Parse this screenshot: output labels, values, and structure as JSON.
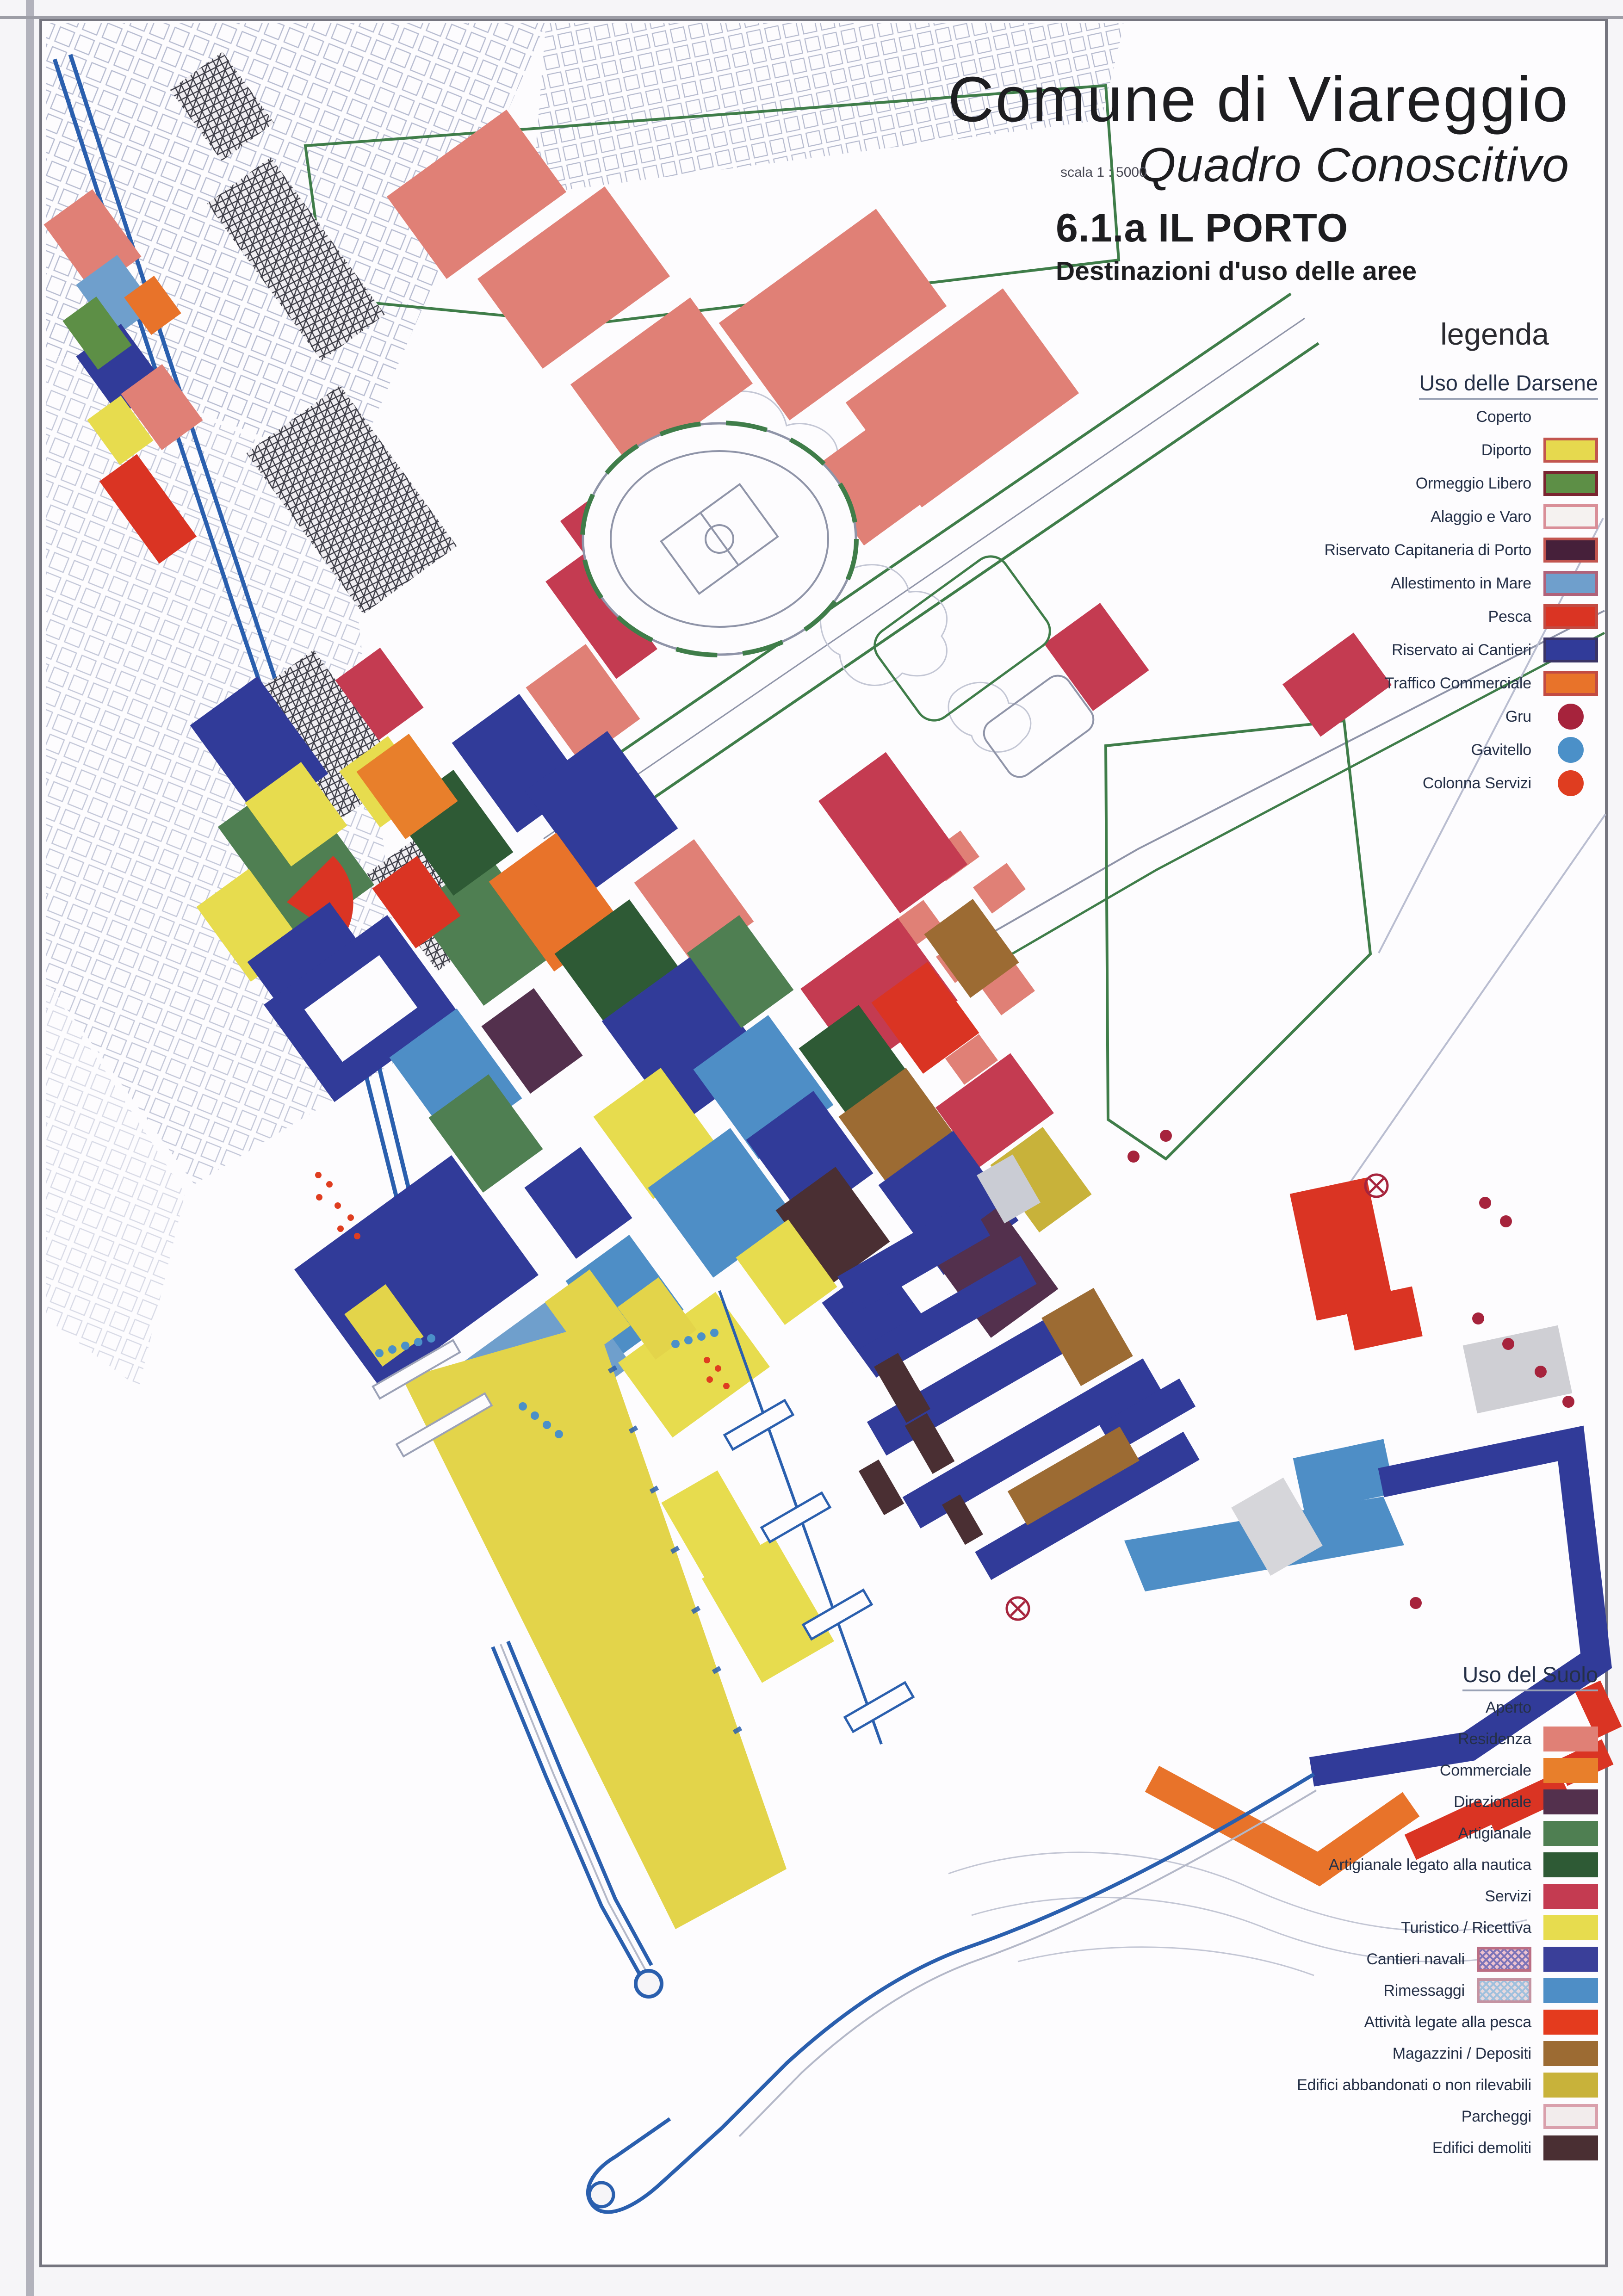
{
  "page": {
    "title": "Comune di Viareggio",
    "subtitle": "Quadro Conoscitivo",
    "scale_label": "scala 1 : 5000",
    "map_code": "6.1.a IL PORTO",
    "map_subtitle": "Destinazioni d'uso delle aree",
    "legend_word": "legenda"
  },
  "legend_darsene": {
    "title": "Uso delle Darsene",
    "items": [
      {
        "label": "Coperto",
        "swatch": "none"
      },
      {
        "label": "Diporto",
        "swatch": "rect",
        "color": "#e6d94e",
        "border": "#c2554f"
      },
      {
        "label": "Ormeggio Libero",
        "swatch": "rect",
        "color": "#5d8f46",
        "border": "#7a2430"
      },
      {
        "label": "Alaggio e Varo",
        "swatch": "rect",
        "color": "#f5f2f0",
        "border": "#d98f98"
      },
      {
        "label": "Riservato Capitaneria di Porto",
        "swatch": "rect",
        "color": "#46203a",
        "border": "#c2554f"
      },
      {
        "label": "Allestimento in Mare",
        "swatch": "rect",
        "color": "#6f9fcc",
        "border": "#b0627a"
      },
      {
        "label": "Pesca",
        "swatch": "rect",
        "color": "#da3423",
        "border": "#c24b43"
      },
      {
        "label": "Riservato ai Cantieri",
        "swatch": "rect",
        "color": "#313b99",
        "border": "#3a3466"
      },
      {
        "label": "Traffico Commerciale",
        "swatch": "rect",
        "color": "#e8732a",
        "border": "#c24b43"
      },
      {
        "label": "Gru",
        "swatch": "circle",
        "color": "#a6233c"
      },
      {
        "label": "Gavitello",
        "swatch": "circle",
        "color": "#4b90c8"
      },
      {
        "label": "Colonna Servizi",
        "swatch": "circle",
        "color": "#df3d20"
      }
    ]
  },
  "legend_suolo": {
    "title": "Uso del Suolo",
    "items": [
      {
        "label": "Aperto",
        "swatch": "none"
      },
      {
        "label": "Residenza",
        "swatch": "rect",
        "color": "#e08076"
      },
      {
        "label": "Commerciale",
        "swatch": "rect",
        "color": "#e87f2b"
      },
      {
        "label": "Direzionale",
        "swatch": "rect",
        "color": "#53304d"
      },
      {
        "label": "Artigianale",
        "swatch": "rect",
        "color": "#4f7f52"
      },
      {
        "label": "Artigianale legato alla nautica",
        "swatch": "rect",
        "color": "#2e5a35"
      },
      {
        "label": "Servizi",
        "swatch": "rect",
        "color": "#c43b51"
      },
      {
        "label": "Turistico / Ricettiva",
        "swatch": "rect",
        "color": "#e7dc4e"
      },
      {
        "label": "Cantieri navali",
        "swatch": "rect-pair",
        "pair": "cn",
        "color": "#3a3f99"
      },
      {
        "label": "Rimessaggi",
        "swatch": "rect-pair",
        "pair": "rm",
        "color": "#4e8ec6"
      },
      {
        "label": "Attività legate alla pesca",
        "swatch": "rect",
        "color": "#e43b1e"
      },
      {
        "label": "Magazzini / Depositi",
        "swatch": "rect",
        "color": "#9c6b33"
      },
      {
        "label": "Edifici abbandonati o non rilevabili",
        "swatch": "rect",
        "color": "#c8b23a"
      },
      {
        "label": "Parcheggi",
        "swatch": "rect",
        "color": "#f2ecec",
        "border": "#d9a0ac"
      },
      {
        "label": "Edifici demoliti",
        "swatch": "rect",
        "color": "#4a2f33"
      }
    ]
  },
  "colors": {
    "paper": "#f6f5f8",
    "map_bg": "#fdfcfe",
    "frame": "#75757f",
    "water": "#2a5fae",
    "outline": "#a9aec8",
    "green_bound": "#3f7d49",
    "text_dark": "#1d1d20",
    "text_label": "#253047",
    "diporto": "#e3d44a",
    "ormeggio": "#5d8f46",
    "alaggio": "#f5f2f0",
    "capitaneria": "#46203a",
    "allestimento": "#6f9fcc",
    "pesca": "#da3423",
    "cantieri": "#313b99",
    "traffico": "#e8732a",
    "gru": "#a6233c",
    "gavitello": "#4b90c8",
    "colonna": "#df3d20",
    "residenza": "#e08076",
    "commerciale": "#e87f2b",
    "direzionale": "#53304d",
    "artigianale": "#4f7f52",
    "nautica": "#2e5a35",
    "servizi": "#c43b51",
    "turistico": "#e7dc4e",
    "rimessaggi": "#4e8ec6",
    "magazzini": "#9c6b33",
    "abbandonati": "#c8b23a",
    "parcheggi": "#f2ecec",
    "demoliti": "#4a2f33",
    "gray_block": "#cfcfd4",
    "hatch_cn_a": "#7d74b8",
    "hatch_cn_b": "#eec3cf",
    "hatch_rm_a": "#9fc0dd",
    "hatch_rm_b": "#e7d9de"
  }
}
